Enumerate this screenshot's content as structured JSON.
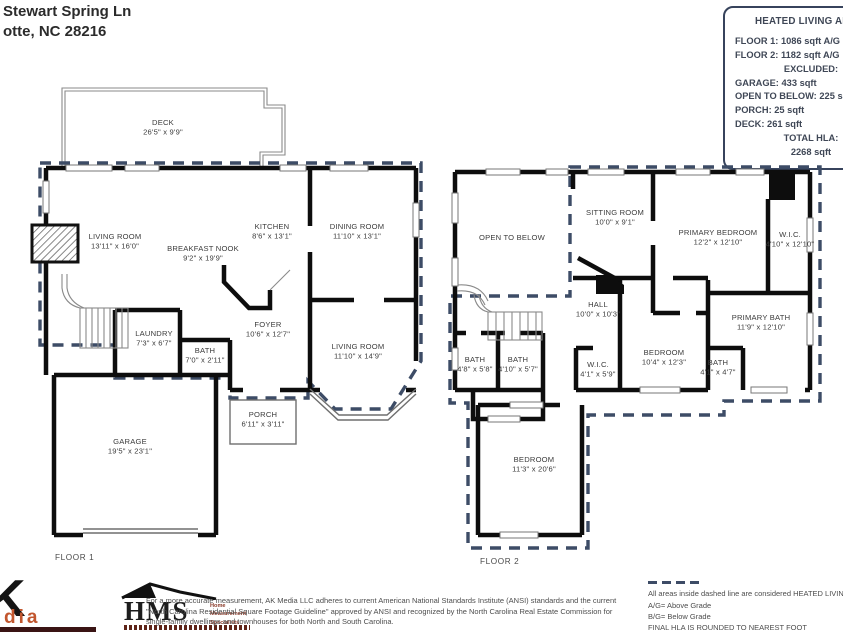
{
  "address": {
    "line1": "Stewart Spring Ln",
    "line2": "otte, NC  28216"
  },
  "hla_box": {
    "title": "HEATED LIVING AREA:",
    "lines": [
      "FLOOR 1: 1086 sqft  A/G",
      "FLOOR 2: 1182 sqft  A/G",
      "EXCLUDED:",
      "GARAGE: 433 sqft",
      "OPEN TO BELOW: 225 sqft",
      "PORCH: 25 sqft",
      "DECK: 261 sqft",
      "TOTAL HLA:",
      "2268 sqft"
    ]
  },
  "colors": {
    "dashed_boundary": "#3d4c66",
    "walls": "#0d0d0d",
    "accent_maroon": "#8a3b2a",
    "accent_orange": "#c2562e"
  },
  "floor1": {
    "label": "FLOOR 1",
    "rooms": [
      {
        "name": "DECK",
        "dims": "26'5\" x 9'9\""
      },
      {
        "name": "LIVING ROOM",
        "dims": "13'11\" x 16'0\""
      },
      {
        "name": "BREAKFAST NOOK",
        "dims": "9'2\" x 19'9\""
      },
      {
        "name": "KITCHEN",
        "dims": "8'6\" x 13'1\""
      },
      {
        "name": "DINING ROOM",
        "dims": "11'10\" x 13'1\""
      },
      {
        "name": "LAUNDRY",
        "dims": "7'3\" x 6'7\""
      },
      {
        "name": "BATH",
        "dims": "7'0\" x 2'11\""
      },
      {
        "name": "FOYER",
        "dims": "10'6\" x 12'7\""
      },
      {
        "name": "LIVING ROOM",
        "dims": "11'10\" x 14'9\""
      },
      {
        "name": "PORCH",
        "dims": "6'11\" x 3'11\""
      },
      {
        "name": "GARAGE",
        "dims": "19'5\" x 23'1\""
      }
    ]
  },
  "floor2": {
    "label": "FLOOR 2",
    "rooms": [
      {
        "name": "OPEN TO BELOW",
        "dims": ""
      },
      {
        "name": "SITTING ROOM",
        "dims": "10'0\" x 9'1\""
      },
      {
        "name": "PRIMARY BEDROOM",
        "dims": "12'2\" x 12'10\""
      },
      {
        "name": "W.I.C.",
        "dims": "4'10\" x 12'10\""
      },
      {
        "name": "HALL",
        "dims": "10'0\" x 10'3\""
      },
      {
        "name": "PRIMARY BATH",
        "dims": "11'9\" x 12'10\""
      },
      {
        "name": "BEDROOM",
        "dims": "10'4\" x 12'3\""
      },
      {
        "name": "BATH",
        "dims": "4'8\" x 5'8\""
      },
      {
        "name": "BATH",
        "dims": "4'10\" x 5'7\""
      },
      {
        "name": "W.I.C.",
        "dims": "4'1\" x 5'9\""
      },
      {
        "name": "BATH",
        "dims": "4'1\" x 4'7\""
      },
      {
        "name": "BEDROOM",
        "dims": "11'3\" x 20'6\""
      }
    ]
  },
  "footer": {
    "ak_logo_letter": "K",
    "ak_logo_sub": "dia",
    "hms_word": "HMS",
    "hms_tagline_1": "Home",
    "hms_tagline_2": "Measurement",
    "hms_tagline_3": "Specialists",
    "disclaimer": "For a more accurate measurement, AK Media LLC adheres to current American National Standards Institute (ANSI) standards and the current \"North Carolina Residential Square Footage Guideline\" approved by ANSI and recognized by the North Carolina Real Estate Commission for single-family dwellings and townhouses for both North and South Carolina.",
    "legend_line_1": "All areas inside dashed line are considered HEATED LIVING",
    "legend_line_2": "A/G= Above Grade",
    "legend_line_3": "B/G= Below Grade",
    "legend_line_4": "FINAL HLA IS ROUNDED TO NEAREST FOOT"
  }
}
